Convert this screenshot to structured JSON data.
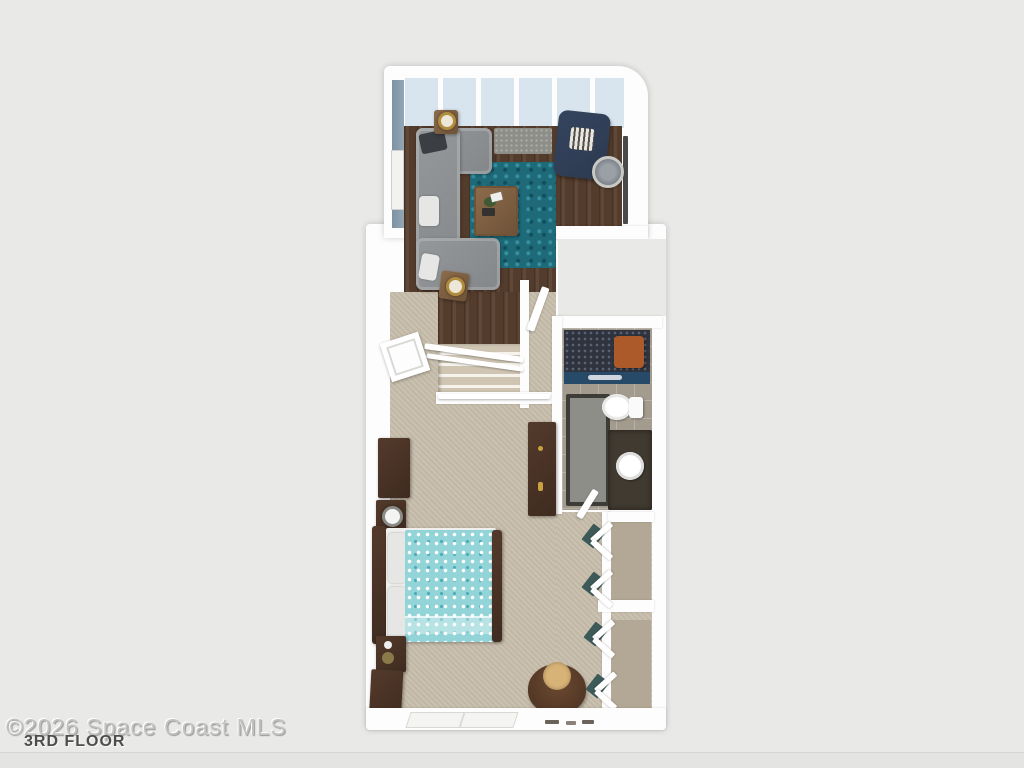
{
  "image": {
    "type": "3d-floor-plan-rendering",
    "watermark": "©2026 Space Coast MLS",
    "floor_label": "3RD FLOOR"
  },
  "palette": {
    "bg": "#e9e9e7",
    "wall_white": "#fdfdfd",
    "wall_blue": "#7c91a3",
    "glass_blue": "#dfe9f1",
    "floor_wood": "#5a4130",
    "floor_carpet": "#c7bdab",
    "floor_tile": "#a39c8e",
    "rug_teal": "#1e6a79",
    "sofa_gray": "#84878a",
    "chair_navy": "#2c3950",
    "bed_teal": "#93d4d8",
    "wood_dark": "#3f2b20",
    "wood_medium": "#8b6b4a",
    "mat_gray": "#8e8e89",
    "shower_dark": "#2e333d",
    "partition_blue": "#264a68",
    "vanity_dark": "#413a31",
    "closet_teal": "#3d5a58",
    "orange_accent": "#ad5a2a",
    "cushion_tan": "#d8b377",
    "watermark_gray": "#c2c2c0",
    "label_gray": "#4d4d4d"
  },
  "scene": {
    "rooms": [
      {
        "name": "living-room",
        "floor": "dark-hardwood",
        "features": [
          "window-wall",
          "blue-accent-wall",
          "wall-art"
        ],
        "furniture": [
          "gray-sectional-sofa",
          "teal-shag-rug",
          "wood-coffee-table",
          "navy-armchair",
          "round-side-table",
          "end-table-with-lamp",
          "end-table-with-lamp",
          "gray-doormat",
          "wall-tv"
        ]
      },
      {
        "name": "staircase",
        "features": [
          "white-railing",
          "carpeted-steps",
          "hardwood-landing",
          "landing-door"
        ]
      },
      {
        "name": "bathroom",
        "floor": "tile",
        "furniture": [
          "walk-in-shower",
          "glass-partition",
          "toilet",
          "vanity-with-vessel-sink",
          "bath-mat"
        ]
      },
      {
        "name": "bedroom",
        "floor": "beige-carpet",
        "furniture": [
          "double-bed-teal-floral-bedding",
          "nightstand-with-lamp",
          "nightstand-with-decor",
          "dresser",
          "tall-wardrobe",
          "papasan-chair",
          "storage-cabinet"
        ]
      },
      {
        "name": "closet",
        "features": [
          "open-louvered-doors",
          "shelf-dividers"
        ]
      }
    ]
  }
}
